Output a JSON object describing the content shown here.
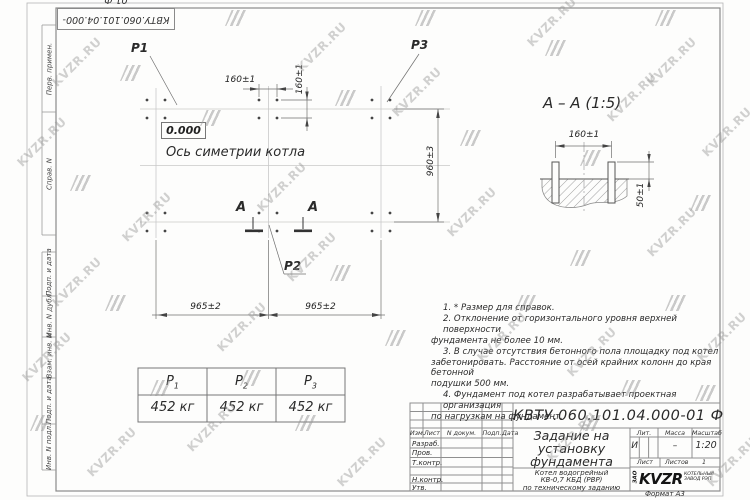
{
  "watermark": {
    "text": "KVZR.RU"
  },
  "stamp": {
    "doc_number": "КВТУ.060.101.04.000-01 Ф"
  },
  "margin_labels": [
    "Перв. примен.",
    "Справ. N",
    "Подп. и дата",
    "Инв. N дубл.",
    "Взам. инв. N",
    "Подп. и дата",
    "Инв. N подл."
  ],
  "plan": {
    "p1": "P1",
    "p2": "P2",
    "p3": "P3",
    "level": "0.000",
    "axis_label": "Ось симетрии котла",
    "dim_160h": "160±1",
    "dim_160v": "160±1",
    "dim_960": "960±3",
    "dim_965_left": "965±2",
    "dim_965_right": "965±2",
    "mark_a_left": "А",
    "mark_a_right": "А"
  },
  "section": {
    "title": "А – А (1:5)",
    "dim_160": "160±1",
    "dim_50": "50±1"
  },
  "notes": [
    "1. * Размер для справок.",
    "2. Отклонение от горизонтального уровня верхней поверхности",
    "фундамента не более 10 мм.",
    "3. В случае отсутствия бетонного пола площадку под котел",
    "забетонировать. Расстояние от осей крайних колонн до края бетонной",
    "подушки 500 мм.",
    "4. Фундамент под котел разрабатывает проектная организация",
    "по нагрузкам на фундамент."
  ],
  "load_table": {
    "cols": [
      {
        "p": "P",
        "sub": "1",
        "value": "452 кг"
      },
      {
        "p": "P",
        "sub": "2",
        "value": "452 кг"
      },
      {
        "p": "P",
        "sub": "3",
        "value": "452 кг"
      }
    ]
  },
  "title_block": {
    "doc_number": "КВТУ.060.101.04.000-01 Ф",
    "title_line1": "Задание на",
    "title_line2": "установку",
    "title_line3": "фундамента",
    "subtitle_line1": "Котел водогрейный",
    "subtitle_line2": "КВ-0,7 КБД (РВР)",
    "subtitle_line3": "по техническому заданию",
    "col_izm": "Изм.",
    "col_list": "Лист",
    "col_doc": "N докум.",
    "col_podp": "Подп.",
    "col_data": "Дата",
    "row_razrab": "Разраб.",
    "row_prov": "Пров.",
    "row_tkontr": "Т.контр.",
    "row_nkontr": "Н.контр.",
    "row_utv": "Утв.",
    "lit_label": "Лит.",
    "lit_value": "И",
    "mass_label": "Масса",
    "mass_value": "–",
    "scale_label": "Масштаб",
    "scale_value": "1:20",
    "sheet_label": "Лист",
    "sheets_label": "Листов",
    "sheets_value": "1",
    "logo_zao": "ЗАО",
    "logo_name": "KVZR",
    "logo_tag1": "КОТЕЛЬНЫЙ",
    "logo_tag2": "ЗАВОД РЭП",
    "format": "Формат А3"
  }
}
